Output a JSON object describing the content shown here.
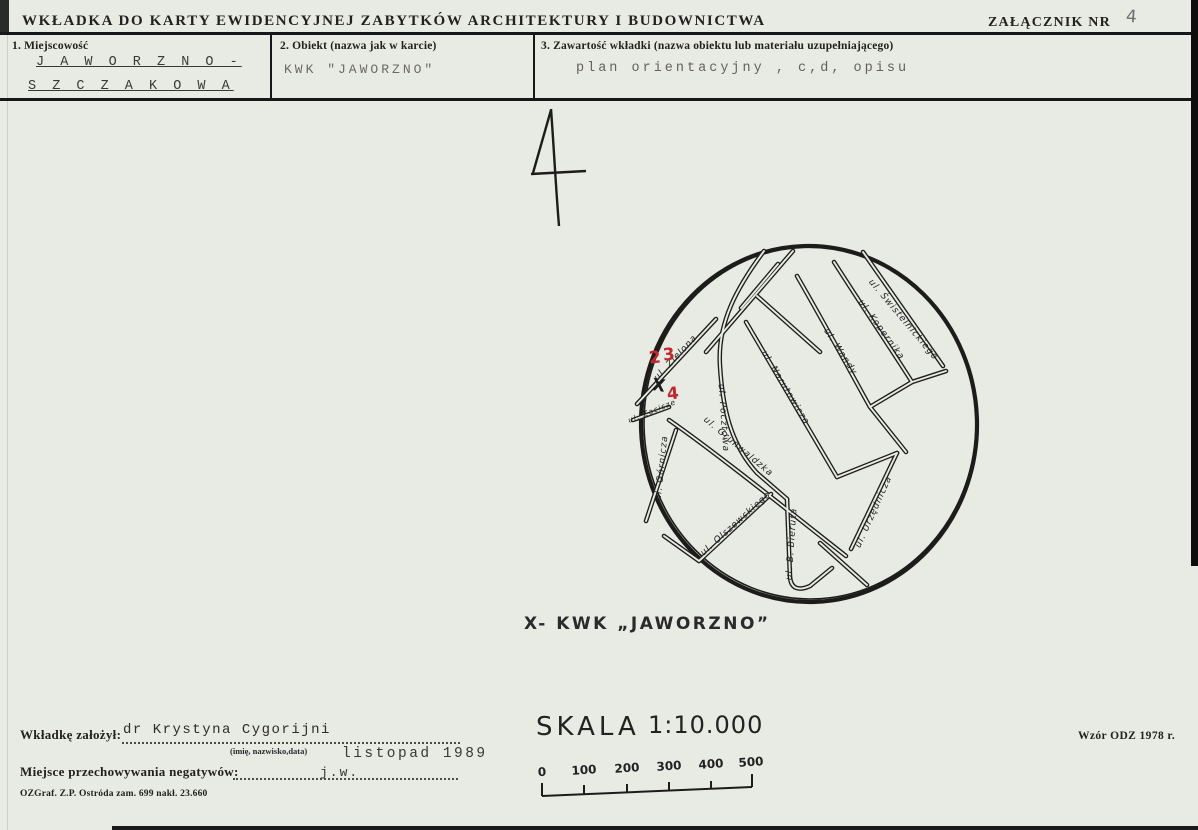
{
  "document": {
    "title": "WKŁADKA DO KARTY EWIDENCYJNEJ ZABYTKÓW ARCHITEKTURY I BUDOWNICTWA",
    "attachment_label": "ZAŁĄCZNIK NR",
    "attachment_number": "4",
    "figure_number": "4"
  },
  "form": {
    "field1_label": "1. Miejscowość",
    "field1_value_line1": "J A W O R Z N O -",
    "field1_value_line2": "S Z C Z A K O W A",
    "field2_label": "2. Obiekt (nazwa jak w karcie)",
    "field2_value": "KWK \"JAWORZNO\"",
    "field3_label": "3. Zawartość wkładki (nazwa obiektu lub materiału uzupełniającego)",
    "field3_value": "plan orientacyjny , c,d, opisu"
  },
  "map": {
    "marker": "X",
    "red_marks": [
      "2",
      "3",
      "4"
    ],
    "streets": [
      "ul. Zielona",
      "ul. Pocztowa",
      "ul. Narutowicza",
      "ul. Wandy",
      "ul. Kopernika",
      "ul. Świstelnickiego",
      "ul. Górnicza",
      "ul. Grunwaldzka",
      "ul. Olszewskiego",
      "ul. B. Bieruta",
      "ul. Urzędnicza",
      "ul. Zacisze"
    ],
    "caption": "X- KWK „JAWORZNO”"
  },
  "scale": {
    "label": "SKALA",
    "ratio": "1:10.000",
    "ticks": [
      "0",
      "100",
      "200",
      "300",
      "400",
      "500"
    ]
  },
  "footer": {
    "founder_label": "Wkładkę założył:",
    "founder_name": "dr Krystyna Cygorijni",
    "founder_hint": "(imię, nazwisko,data)",
    "founder_date": "listopad 1989",
    "negatives_label": "Miejsce przechowywania negatywów:",
    "negatives_value": "j.w.",
    "print_note": "OZGraf. Z.P. Ostróda zam. 699 nakł. 23.660",
    "template_note": "Wzór ODZ 1978 r."
  }
}
